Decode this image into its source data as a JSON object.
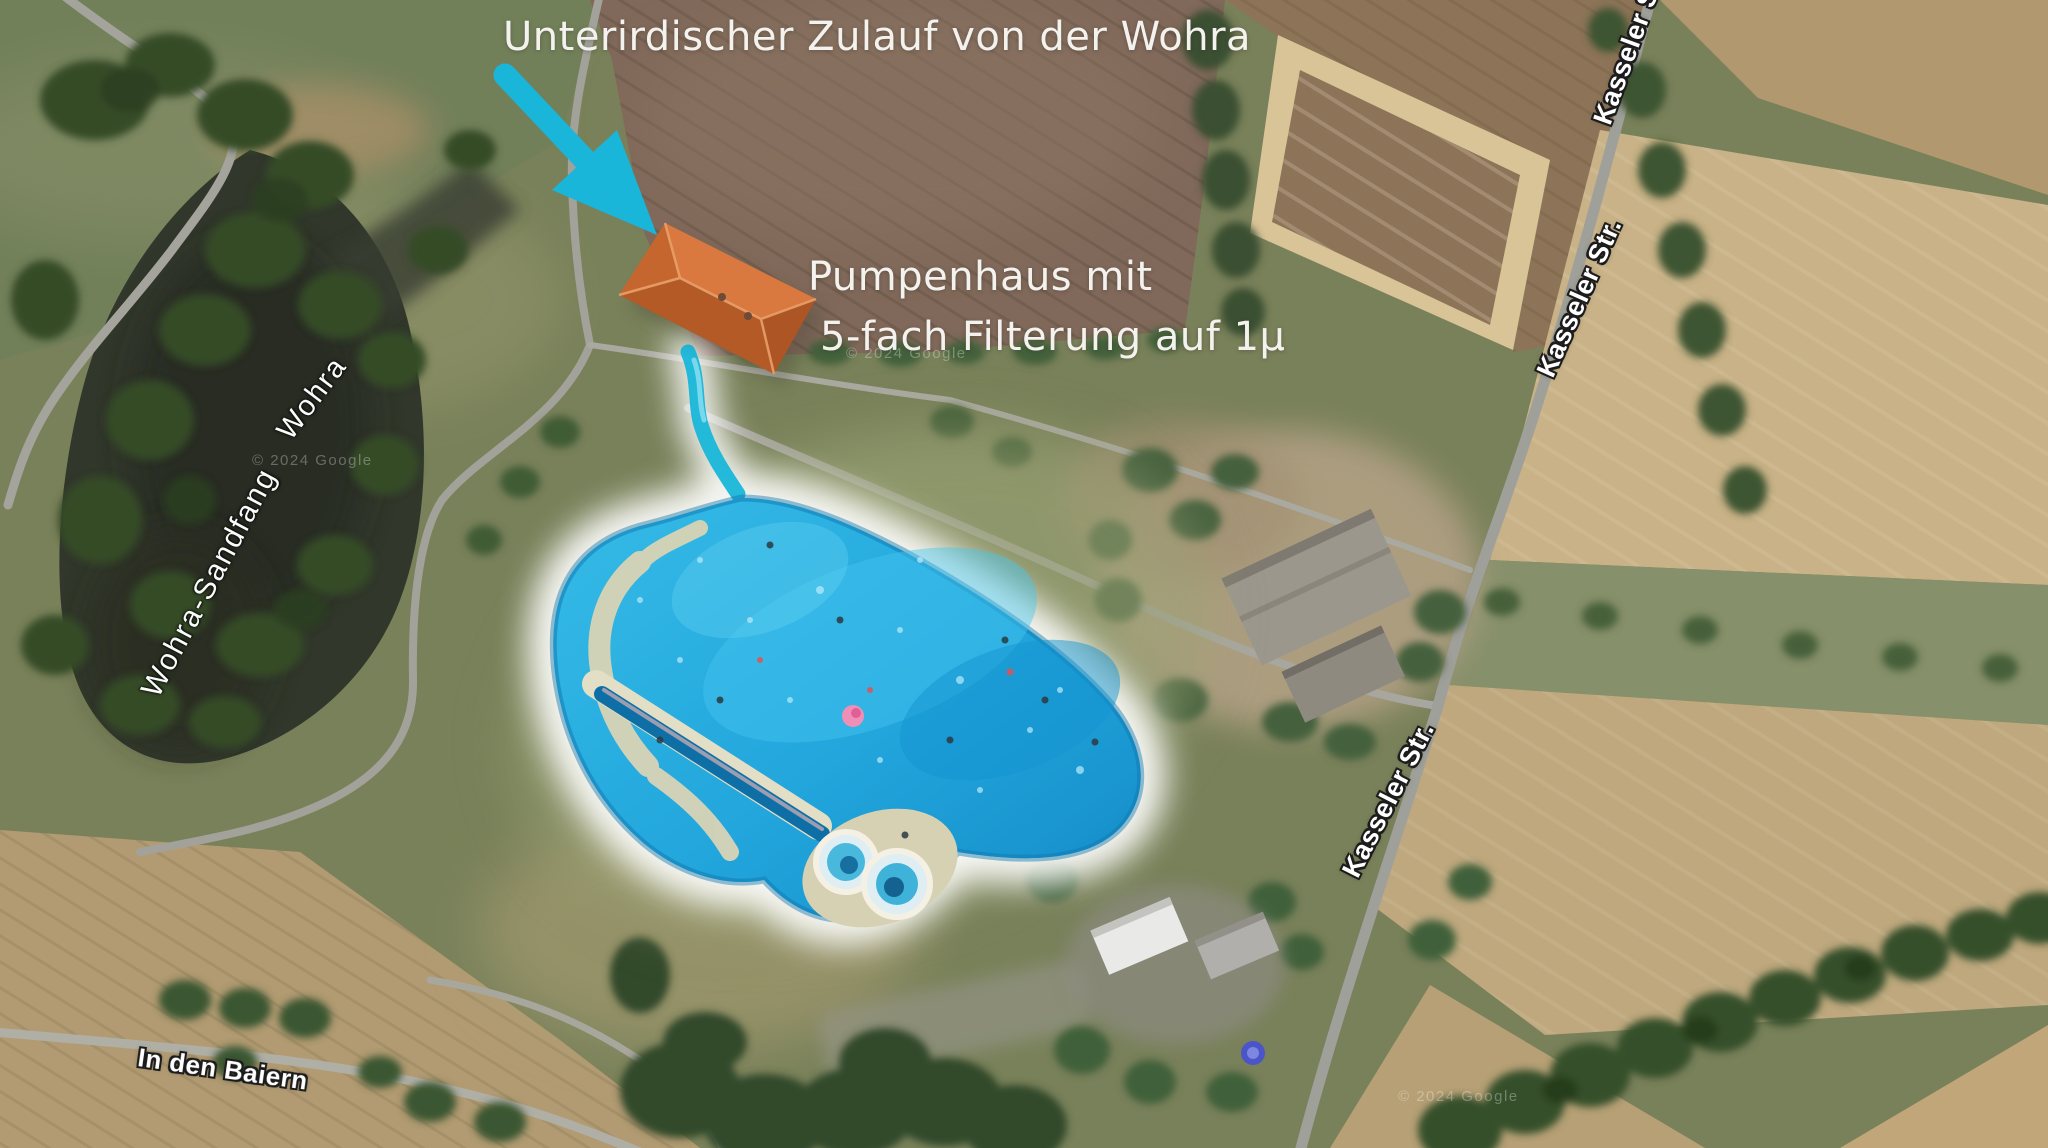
{
  "annotations": {
    "inflow": "Unterirdischer Zulauf von der Wohra",
    "pumphouse_line1": "Pumpenhaus mit",
    "pumphouse_line2": "5-fach Filterung auf 1µ"
  },
  "labels": {
    "wohra": "Wohra",
    "sandfang": "Wohra-Sandfang",
    "kasseler_top": "Kasseler Str.",
    "kasseler_upper": "Kasseler Str.",
    "kasseler_mid": "Kasseler Str.",
    "baiern": "In den Baiern"
  },
  "watermark": {
    "text": "© 2024 Google"
  },
  "colors": {
    "arrow": "#19b6d9",
    "pool_water": "#1f9fd6",
    "pool_glow": "#ffffff",
    "roof_light": "#d9793f",
    "roof_dark": "#b35a26"
  }
}
